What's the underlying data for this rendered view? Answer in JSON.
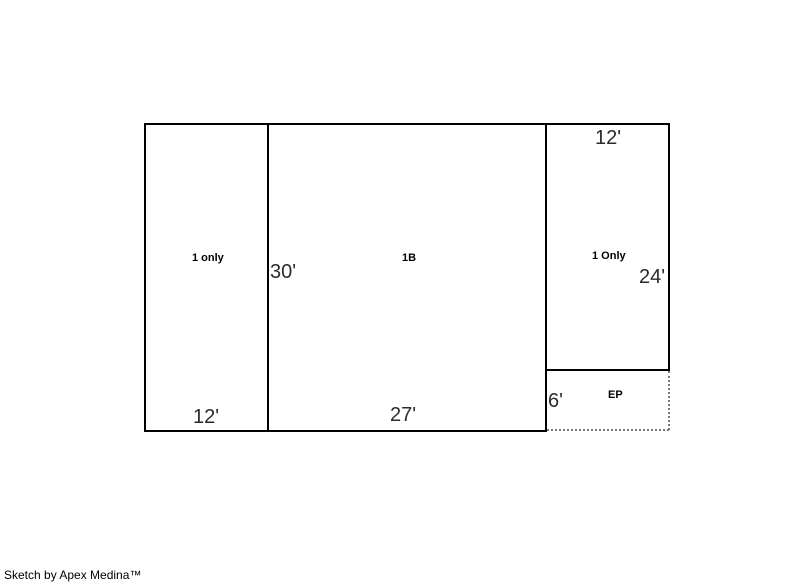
{
  "sketch": {
    "line_color": "#000000",
    "dotted_line_color": "#777777",
    "background": "#ffffff",
    "rooms": {
      "left": {
        "name": "1 only",
        "width_dim": "12'"
      },
      "middle": {
        "name": "1B",
        "height_dim": "30'",
        "width_dim": "27'"
      },
      "right": {
        "name": "1 Only",
        "width_dim": "12'",
        "height_dim": "24'"
      },
      "porch": {
        "name": "EP",
        "height_dim": "6'"
      }
    }
  },
  "footer": {
    "credit": "Sketch by Apex Medina™"
  }
}
